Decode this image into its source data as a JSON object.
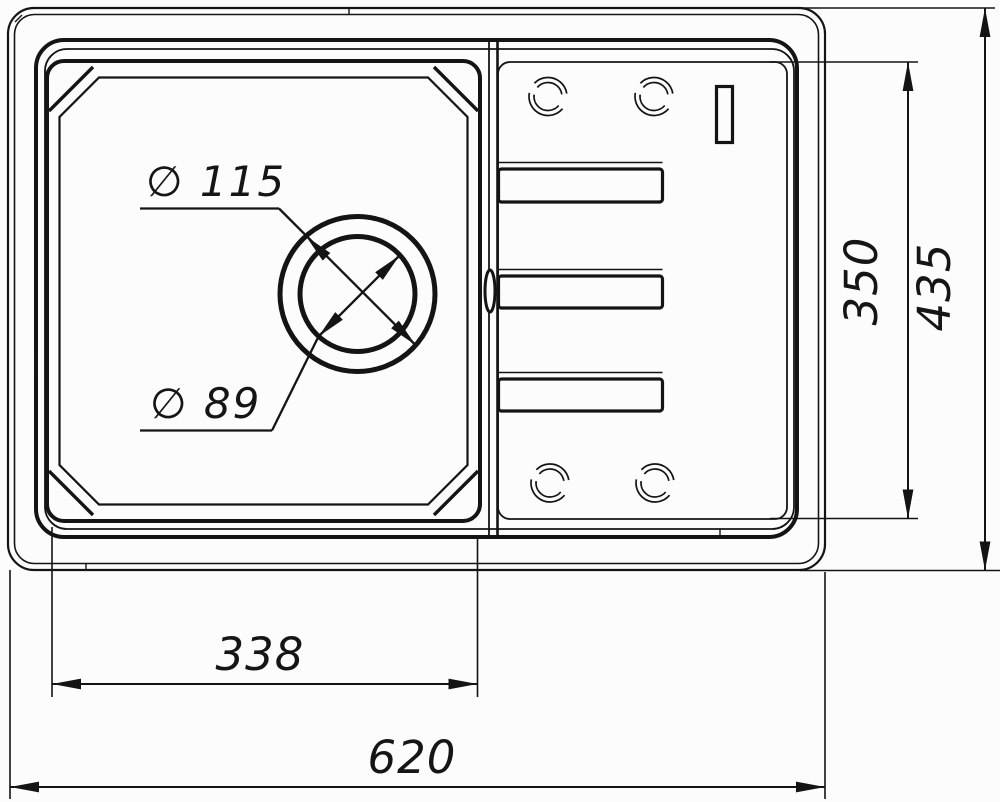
{
  "drawing": {
    "title": "sink-top-view-technical-drawing",
    "dimensions": {
      "drain_outer_diameter": "∅ 115",
      "drain_inner_diameter": "∅ 89",
      "drainboard_depth": "350",
      "overall_depth": "435",
      "bowl_width": "338",
      "overall_width": "620"
    },
    "colors": {
      "line": "#141414",
      "background": "#fcfcfc"
    }
  }
}
